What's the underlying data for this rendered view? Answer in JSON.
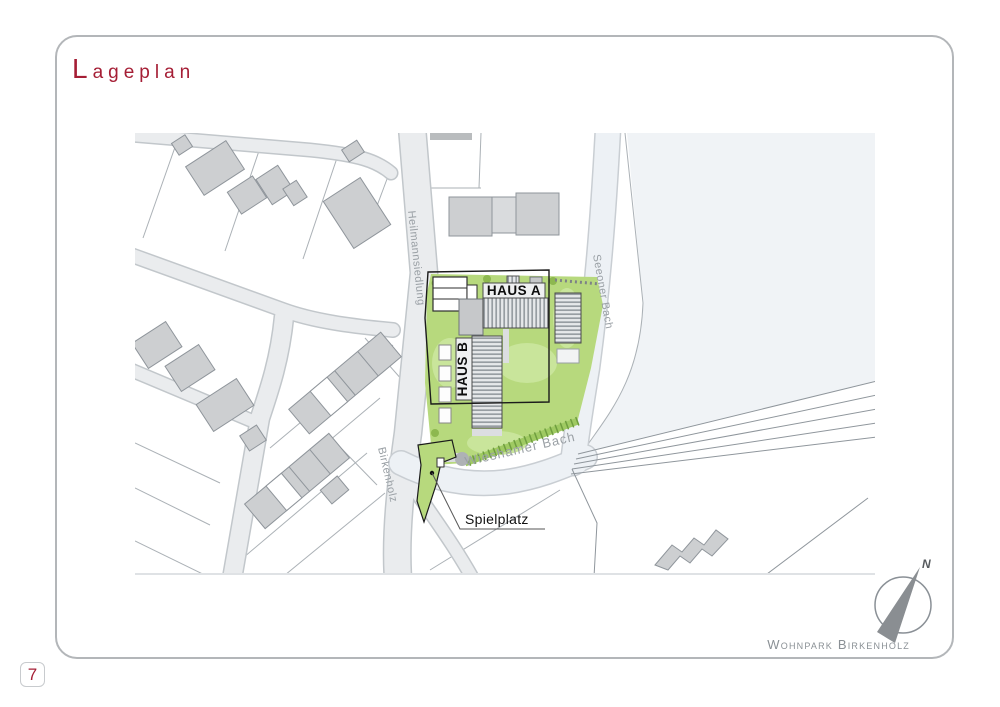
{
  "title": "Lageplan",
  "page_number": "7",
  "footer": "Wohnpark Birkenholz",
  "compass": {
    "north_label": "N"
  },
  "map": {
    "streets": {
      "heilmannsiedlung": "Heilmannsiedlung",
      "seeoner_bach": "Seeoner Bach",
      "birkenholz": "Birkenholz",
      "wieshamer_bach": "Wieshamer Bach"
    },
    "buildings": {
      "haus_a": "HAUS A",
      "haus_b": "HAUS B"
    },
    "labels": {
      "playground": "Spielplatz"
    }
  },
  "colors": {
    "accent_red": "#a51e35",
    "site_green": "#b7d97d",
    "light_green": "#c9e59b",
    "hedge_green": "#6f9e3f",
    "building_gray": "#cdcfd1",
    "street_gray": "#eaecee",
    "water_gray": "#edf1f5",
    "label_gray": "#9aa0a5",
    "boundary_black": "#1b1b1b"
  }
}
